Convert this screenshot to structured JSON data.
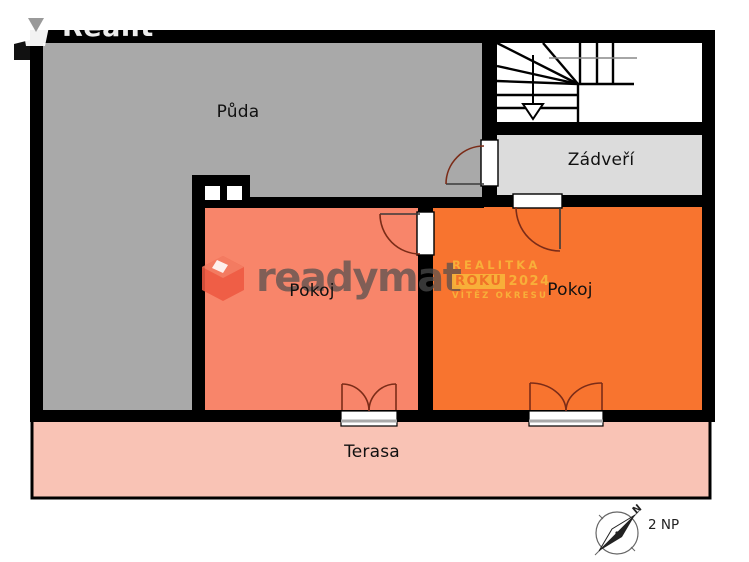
{
  "brand": {
    "name": "Realit"
  },
  "plan": {
    "rooms": [
      {
        "id": "puda",
        "label": "Půda"
      },
      {
        "id": "zadveri",
        "label": "Zádveří"
      },
      {
        "id": "pokoj_left",
        "label": "Pokoj"
      },
      {
        "id": "pokoj_right",
        "label": "Pokoj"
      },
      {
        "id": "terasa",
        "label": "Terasa"
      }
    ],
    "floor_label": "2 NP",
    "compass_north": "N"
  },
  "watermark": {
    "logo_text": "readymat",
    "award_line1": "REALITKA",
    "award_line2_word": "ROKU",
    "award_line2_year": "2024",
    "award_line3": "VÍTĚZ OKRESU"
  },
  "colors": {
    "wall": "#000000",
    "room_puda": "#a9a9a9",
    "room_zadveri": "#dcdcdc",
    "room_pokoj_left": "#f8856a",
    "room_pokoj_right": "#f8742f",
    "room_terasa": "#f9c3b5",
    "door_arc": "#7b2c18",
    "stair_line": "#000000",
    "watermark_text": "#4f4f4f",
    "watermark_cube": "#ee5942",
    "award_yellow": "#f9b43a",
    "award_orange_text": "#f07228"
  }
}
